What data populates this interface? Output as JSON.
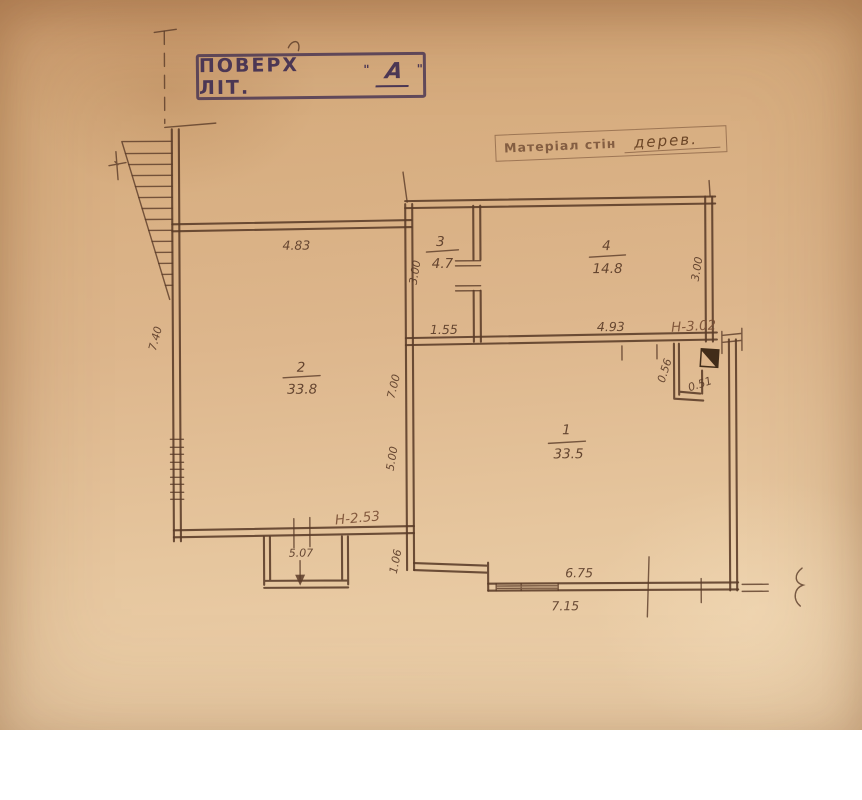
{
  "colors": {
    "paper_top": "#cf9f72",
    "paper_mid": "#ddb68c",
    "paper_bottom": "#eed3ae",
    "ink": "#5a3b28",
    "ink_dark": "#33200f",
    "stamp_ink": "#4b3754",
    "faded_ink": "#7a4f35"
  },
  "stamp": {
    "title": "ПОВЕРХ ЛІТ.",
    "quote_open": "\"",
    "letter": "А",
    "quote_close": "\""
  },
  "material": {
    "label": "Матеріал стін",
    "value": "дерев."
  },
  "rooms": {
    "r1": {
      "number": "1",
      "area": "33.5"
    },
    "r2": {
      "number": "2",
      "area": "33.8"
    },
    "r3": {
      "number": "3",
      "area": "4.7"
    },
    "r4": {
      "number": "4",
      "area": "14.8"
    }
  },
  "dims": {
    "room2_width": "4.83",
    "left_wall_height": "7.40",
    "room3_height": "3.00",
    "room3_width": "1.55",
    "room4_width": "4.93",
    "room4_height": "3.00",
    "ceiling_height_top": "Н-3.02",
    "mid_wall_upper": "7.00",
    "mid_wall_lower": "5.00",
    "ceiling_height_left": "Н-2.53",
    "porch_width": "5.07",
    "bottom_step": "1.06",
    "chimney_width": "0.56",
    "chimney_depth": "0.51",
    "room1_width": "6.75",
    "bottom_total": "7.15"
  }
}
